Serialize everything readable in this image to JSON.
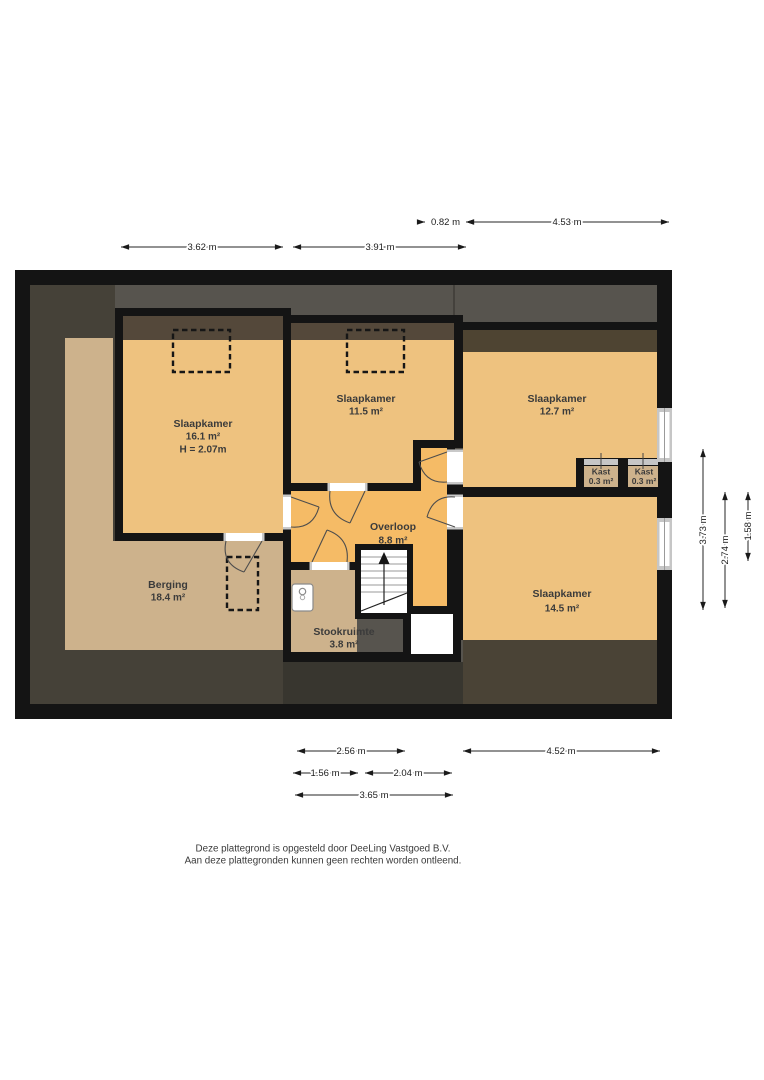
{
  "plan": {
    "rooms": {
      "s1": {
        "name": "Slaapkamer",
        "area": "16.1 m²",
        "height": "H = 2.07m"
      },
      "s2": {
        "name": "Slaapkamer",
        "area": "11.5 m²"
      },
      "s3": {
        "name": "Slaapkamer",
        "area": "12.7 m²"
      },
      "s4": {
        "name": "Slaapkamer",
        "area": "14.5 m²"
      },
      "overloop": {
        "name": "Overloop",
        "area": "8.8 m²"
      },
      "berging": {
        "name": "Berging",
        "area": "18.4 m²"
      },
      "stookruimte": {
        "name": "Stookruimte",
        "area": "3.8 m²"
      },
      "kast1": {
        "name": "Kast",
        "area": "0.3 m²"
      },
      "kast2": {
        "name": "Kast",
        "area": "0.3 m²"
      }
    },
    "dimensions": {
      "top_small": "0.82 m",
      "top_right": "4.53 m",
      "top_left": "3.62 m",
      "top_mid": "3.91 m",
      "bottom_row1_left": "2.56 m",
      "bottom_row1_right": "4.52 m",
      "bottom_row2_left": "1.56 m",
      "bottom_row2_right": "2.04 m",
      "bottom_row3": "3.65 m",
      "right_outer": "3.73 m",
      "right_mid": "2.74 m",
      "right_inner": "1.58 m"
    },
    "colors": {
      "wall": "#141414",
      "bedroom_floor": "#eec27f",
      "landing_floor": "#f5bb66",
      "storage_floor": "#cdb28c",
      "roof_band_gray": "#57544e",
      "roof_dark_brown": "#54483a",
      "roof_left_dark": "#454138",
      "window_frame": "#c6c6c6"
    }
  },
  "footer": {
    "line1": "Deze plattegrond is opgesteld door DeeLing Vastgoed B.V.",
    "line2": "Aan deze plattegronden kunnen geen rechten worden ontleend."
  }
}
